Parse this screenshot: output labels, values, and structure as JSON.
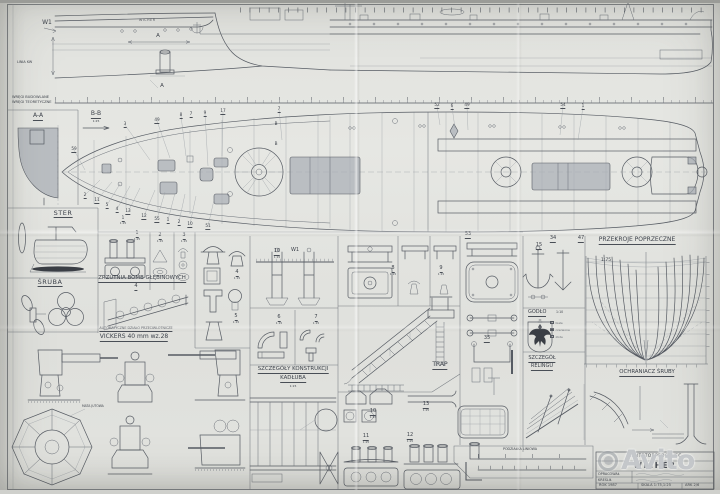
{
  "drawing_labels": {
    "w1": "W1",
    "linia_kw": "LINIA KW",
    "wregi_1": "WRĘGI BUDOWLANE",
    "wregi_2": "WRĘGI TEORETYCZNE",
    "hull_name": "WICHER",
    "section_a_fore": "A",
    "section_a_aft": "A",
    "section_aa": "A-A",
    "section_bb": "B-B",
    "section_bb_scale": "1:25",
    "ster": "STER",
    "sruba": "ŚRUBA",
    "zrzutnia": "ZRZUTNIA BOMB GŁĘBINOWYCH",
    "dzialo": "AUTOMATYCZNE DZIAŁO PRZECIWLOTNICZE",
    "vickers": "VICKERS 40 mm wz.28",
    "mata_jutowa": "MATA JUTOWA",
    "kadlub_1": "SZCZEGÓŁY KONSTRUKCJI",
    "kadlub_2": "KADŁUBA",
    "kadlub_scale": "1:15",
    "trap": "TRAP",
    "godlo": "GODŁO",
    "godlo_scale": "1:10",
    "reling_1": "SZCZEGÓŁ",
    "reling_2": "RELINGU",
    "przekroje": "PRZEKROJE POPRZECZNE",
    "przekroje_scale": "1:75",
    "ochraniacz": "OCHRANIACZ ŚRUBY",
    "podzialka": "PODZIAŁKA LINIOWA"
  },
  "godlo_legend": [
    "białe",
    "czerwone",
    "złote"
  ],
  "detail_numbers": [
    {
      "t": "1",
      "sub": "1:25",
      "x": 137,
      "y": 231
    },
    {
      "t": "2",
      "sub": "1:15",
      "x": 160,
      "y": 233
    },
    {
      "t": "3",
      "sub": "1:15",
      "x": 184,
      "y": 233
    },
    {
      "t": "4",
      "sub": "1:15",
      "x": 237,
      "y": 270
    },
    {
      "t": "5",
      "sub": "1:15",
      "x": 236,
      "y": 314
    },
    {
      "t": "10",
      "sub": "1:15",
      "x": 277,
      "y": 249
    },
    {
      "t": "W1",
      "x": 295,
      "y": 248,
      "nu": true
    },
    {
      "t": "6",
      "sub": "1:15",
      "x": 279,
      "y": 315
    },
    {
      "t": "7",
      "sub": "1:15",
      "x": 316,
      "y": 315
    },
    {
      "t": "8",
      "sub": "1:15",
      "x": 393,
      "y": 266
    },
    {
      "t": "9",
      "sub": "1:15",
      "x": 441,
      "y": 266
    },
    {
      "t": "53",
      "x": 468,
      "y": 232
    },
    {
      "t": "34",
      "x": 553,
      "y": 236
    },
    {
      "t": "47",
      "x": 581,
      "y": 236
    },
    {
      "t": "15",
      "x": 539,
      "y": 243
    },
    {
      "t": "10",
      "sub": "1:15",
      "x": 373,
      "y": 409
    },
    {
      "t": "13",
      "sub": "1:25",
      "x": 426,
      "y": 402
    },
    {
      "t": "11",
      "sub": "1:25",
      "x": 366,
      "y": 434
    },
    {
      "t": "12",
      "sub": "1:25",
      "x": 410,
      "y": 433
    },
    {
      "t": "4",
      "x": 136,
      "y": 284
    },
    {
      "t": "35",
      "x": 487,
      "y": 336
    }
  ],
  "plan_callouts": [
    {
      "t": "59",
      "x": 74,
      "y": 147
    },
    {
      "t": "3",
      "x": 125,
      "y": 122
    },
    {
      "t": "49",
      "x": 157,
      "y": 118
    },
    {
      "t": "8",
      "x": 181,
      "y": 113
    },
    {
      "t": "7",
      "x": 191,
      "y": 112
    },
    {
      "t": "9",
      "x": 205,
      "y": 111
    },
    {
      "t": "17",
      "x": 223,
      "y": 109
    },
    {
      "t": "7",
      "x": 279,
      "y": 107
    },
    {
      "t": "B",
      "x": 276,
      "y": 122,
      "nu": true
    },
    {
      "t": "B",
      "x": 276,
      "y": 142,
      "nu": true
    },
    {
      "t": "52",
      "x": 437,
      "y": 103
    },
    {
      "t": "6",
      "x": 452,
      "y": 104
    },
    {
      "t": "49",
      "x": 467,
      "y": 103
    },
    {
      "t": "54",
      "x": 563,
      "y": 103
    },
    {
      "t": "1",
      "x": 583,
      "y": 104
    },
    {
      "t": "2",
      "x": 85,
      "y": 193
    },
    {
      "t": "11",
      "x": 97,
      "y": 198
    },
    {
      "t": "5",
      "x": 107,
      "y": 203
    },
    {
      "t": "4",
      "x": 117,
      "y": 207
    },
    {
      "t": "13",
      "x": 128,
      "y": 209
    },
    {
      "t": "12",
      "x": 144,
      "y": 214
    },
    {
      "t": "55",
      "x": 157,
      "y": 217
    },
    {
      "t": "1",
      "x": 168,
      "y": 218
    },
    {
      "t": "2",
      "x": 179,
      "y": 220
    },
    {
      "t": "10",
      "x": 190,
      "y": 222
    },
    {
      "t": "51",
      "x": 208,
      "y": 224
    },
    {
      "t": "1",
      "sub": "1:25",
      "x": 123,
      "y": 216
    }
  ],
  "title_block": {
    "vessel_type": "KONTRTORPEDOWIEC",
    "vessel_name": "WICHER",
    "label_oprac": "OPRACOWAŁ",
    "label_kresl": "KREŚLIŁ",
    "rok": "ROK 1987",
    "skala": "SKALA 1:75,1:25",
    "ark": "ARK 2/6"
  },
  "watermark": {
    "text": "Avito",
    "icon": "avito-logo-dot-icon",
    "color": "#a0a4aa"
  }
}
